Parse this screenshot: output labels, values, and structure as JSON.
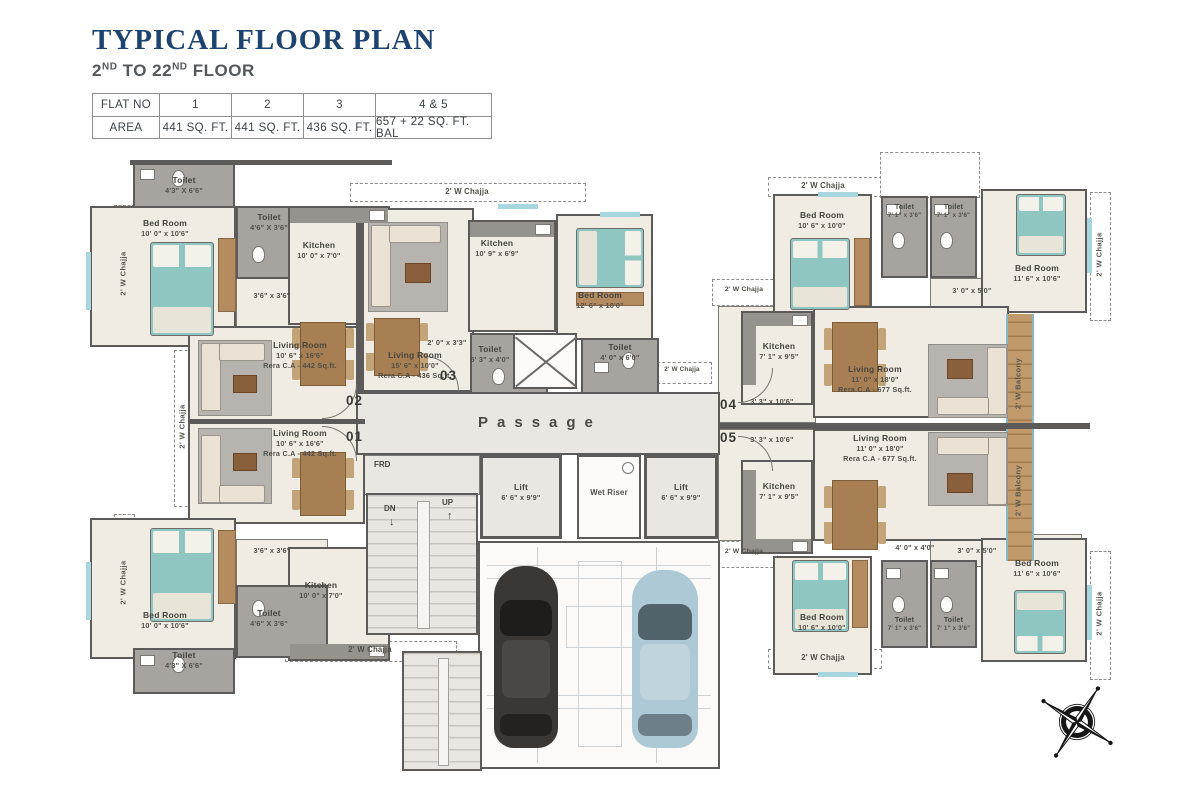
{
  "header": {
    "title": "TYPICAL FLOOR PLAN",
    "floor_prefix": "2",
    "floor_sup_a": "ND",
    "floor_mid": " TO 22",
    "floor_sup_b": "ND",
    "floor_suffix": " FLOOR"
  },
  "area_table": {
    "flat_no_label": "FLAT NO",
    "area_label": "AREA",
    "flat_nos": [
      "1",
      "2",
      "3",
      "4 & 5"
    ],
    "areas": [
      "441 SQ. FT.",
      "441 SQ. FT.",
      "436 SQ. FT.",
      "657 + 22 SQ. FT. BAL"
    ]
  },
  "rooms": {
    "f2_toilet_corner": {
      "name": "Toilet",
      "dims": "4'3\" X 6'6\""
    },
    "f2_bed": {
      "name": "Bed Room",
      "dims": "10' 0\" x 10'6\""
    },
    "f2_toilet": {
      "name": "Toilet",
      "dims": "4'6\" X 3'6\""
    },
    "f2_kitchen": {
      "name": "Kitchen",
      "dims": "10' 0\" x 7'0\""
    },
    "f2_living": {
      "name": "Living Room",
      "dims": "10' 6\" x 16'6\"",
      "area": "Rera C.A - 442 Sq.ft."
    },
    "f1_living": {
      "name": "Living Room",
      "dims": "10' 6\" x 16'6\"",
      "area": "Rera C.A - 442 Sq.ft."
    },
    "f1_kitchen": {
      "name": "Kitchen",
      "dims": "10' 0\" x 7'0\""
    },
    "f1_toilet": {
      "name": "Toilet",
      "dims": "4'6\" X 3'6\""
    },
    "f1_bed": {
      "name": "Bed Room",
      "dims": "10' 0\" x 10'6\""
    },
    "f1_toilet_corner": {
      "name": "Toilet",
      "dims": "4'3\" X 6'6\""
    },
    "f3_kitchen": {
      "name": "Kitchen",
      "dims": "10' 9\" x 6'9\""
    },
    "f3_living": {
      "name": "Living Room",
      "dims": "15' 6\" x 10'0\"",
      "area": "Rera C.A - 436 Sq.ft."
    },
    "f3_bed": {
      "name": "Bed Room",
      "dims": "12' 6\" x 10'0\""
    },
    "f3_toilet_a": {
      "name": "Toilet",
      "dims": "5' 3\" x 4'0\""
    },
    "f3_toilet_b": {
      "name": "Toilet",
      "dims": "4' 0\" x 6'0\""
    },
    "f4_bed_a": {
      "name": "Bed Room",
      "dims": "10' 6\" x 10'0\""
    },
    "f4_toilet_a": {
      "name": "Toilet",
      "dims": "7' 1\" x 3'6\""
    },
    "f4_toilet_b": {
      "name": "Toilet",
      "dims": "7' 1\" x 3'6\""
    },
    "f4_bed_b": {
      "name": "Bed Room",
      "dims": "11' 6\" x 10'6\""
    },
    "f4_kitchen": {
      "name": "Kitchen",
      "dims": "7' 1\" x 9'5\""
    },
    "f4_living": {
      "name": "Living Room",
      "dims": "11' 0\" x 18'0\"",
      "area": "Rera C.A - 677 Sq.ft."
    },
    "f5_living": {
      "name": "Living Room",
      "dims": "11' 0\" x 18'0\"",
      "area": "Rera C.A - 677 Sq.ft."
    },
    "f5_kitchen": {
      "name": "Kitchen",
      "dims": "7' 1\" x 9'5\""
    },
    "f5_bed_a": {
      "name": "Bed Room",
      "dims": "10' 6\" x 10'0\""
    },
    "f5_toilet_a": {
      "name": "Toilet",
      "dims": "7' 1\" x 3'6\""
    },
    "f5_toilet_b": {
      "name": "Toilet",
      "dims": "7' 1\" x 3'6\""
    },
    "f5_bed_b": {
      "name": "Bed Room",
      "dims": "11' 6\" x 10'6\""
    },
    "lift_a": {
      "name": "Lift",
      "dims": "6' 6\" x 9'9\""
    },
    "lift_b": {
      "name": "Lift",
      "dims": "6' 6\" x 9'9\""
    }
  },
  "passages": {
    "f2": "3'6\" x 3'6\"",
    "f1": "3'6\" x 3'6\"",
    "f3": "2' 0\" x 3'3\"",
    "f4_entry": "3' 3\" x 10'6\"",
    "f5_entry": "3' 3\" x 10'6\"",
    "f4_inner": "3' 0\" x 5'0\"",
    "f5_inner_a": "4' 0\" x 4'0\"",
    "f5_inner_b": "3' 0\" x 5'0\""
  },
  "labels": {
    "passage": "Passage",
    "wet_riser": "Wet Riser",
    "frd": "FRD",
    "up": "UP",
    "dn": "DN",
    "chajja": "2' W Chajja",
    "balcony": "2' W Balcony"
  },
  "flat_markers": {
    "f1": "01",
    "f2": "02",
    "f3": "03",
    "f4": "04",
    "f5": "05"
  },
  "icons": {
    "up_arrow": "↑",
    "down_arrow": "↓",
    "compass": "compass-rose"
  },
  "colors": {
    "title_blue": "#1d4370",
    "wall": "#5d5b59",
    "teal": "#8fc6c2",
    "wood": "#b38c60"
  }
}
